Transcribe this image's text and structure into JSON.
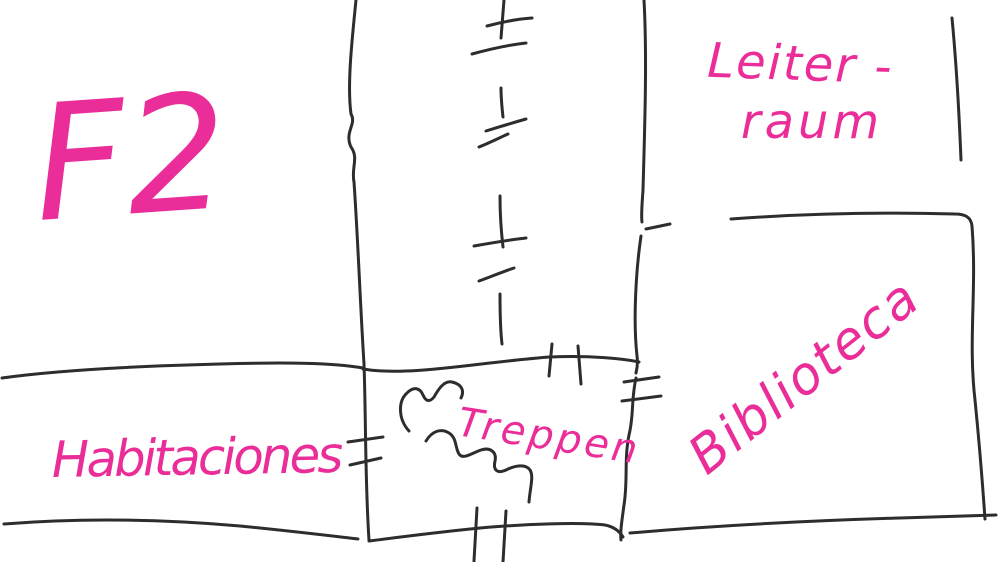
{
  "canvas": {
    "width": 1000,
    "height": 562,
    "background_color": "#ffffff"
  },
  "sketch": {
    "ink_color": "#2d2d2d",
    "marker_color": "#ea2d98",
    "labels": {
      "floor": "F2",
      "leiterraum_line1": "Leiter -",
      "leiterraum_line2": "raum",
      "biblioteca": "Biblioteca",
      "habitaciones": "Habitaciones",
      "treppen": "Treppen"
    }
  }
}
